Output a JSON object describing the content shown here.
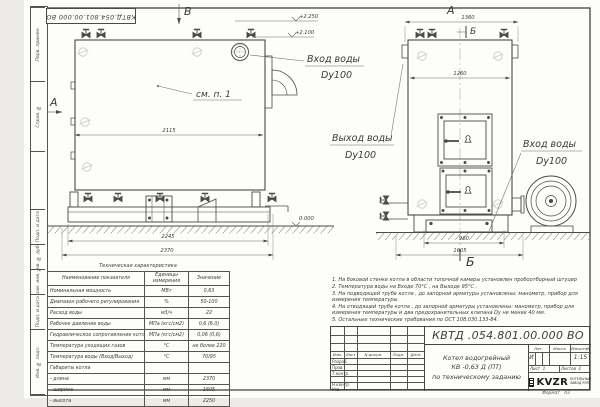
{
  "doc_number_stamp": "КВТД.054.801.00.000 ВО",
  "frame": {
    "side_labels": [
      "Перв. примен.",
      "Справ. №",
      "Подп. и дата",
      "Инв. № дубл.",
      "Взам. инв. №",
      "Подп. и дата",
      "Инв. № подл."
    ]
  },
  "drawing": {
    "b_marker": "В",
    "a_marker_side": "А",
    "see_note": "см. п. 1",
    "elev1": "+2.250",
    "elev2": "+2.100",
    "elev0": "0.000",
    "d2115": "2115",
    "d2245": "2245",
    "d2370": "2370",
    "inlet_top_1": "Вход воды",
    "inlet_top_2": "Dy100",
    "a_title": "А",
    "b_top": "Б",
    "b_bottom": "Б",
    "d1360": "1360",
    "d1260": "1260",
    "d960": "960",
    "d1605": "1605",
    "outlet_1": "Выход воды",
    "outlet_2": "Dy100",
    "inlet_r_1": "Вход воды",
    "inlet_r_2": "Dy100"
  },
  "table": {
    "title": "Техническая характеристика",
    "headers": [
      "Наименование показателя",
      "Единицы измерения",
      "Значение"
    ],
    "rows": [
      [
        "Номинальная мощность",
        "МВт",
        "0,63"
      ],
      [
        "Диапазон рабочего регулирования",
        "%",
        "50-100"
      ],
      [
        "Расход воды",
        "м3/ч",
        "22"
      ],
      [
        "Рабочее давление воды",
        "МПа (кгс/см2)",
        "0,6 (6,0)"
      ],
      [
        "Гидравлическое сопротивление котла",
        "МПа (кгс/см2)",
        "0,06 (0,6)"
      ],
      [
        "Температура уходящих газов",
        "°С",
        "не более 220"
      ],
      [
        "Температура воды (Вход/Выход)",
        "°С",
        "70/95"
      ],
      [
        "Габариты котла",
        "",
        ""
      ],
      [
        "   - длина",
        "мм",
        "2370"
      ],
      [
        "   - ширина",
        "мм",
        "1605"
      ],
      [
        "   - высота",
        "мм",
        "2250"
      ]
    ]
  },
  "notes": {
    "lines": [
      "1.  На боковой стенке котла в области топочной камеры установлен пробоотборный штуцер",
      "2.  Температура воды на Входе  70°С ,  на Выходе  95°С .",
      "3.  На подводящей трубе котла ,  до запорной арматуры установлены:  манометр,  прибор для измерения температуры.",
      "4.  На отводящей трубе котла , до запорной арматуры установлены:  манометр,  прибор для измерения температуры и два предохранительных клапана  Dу не менее  40 мм.",
      "5.  Остальные технические требования по ОСТ  108.030.133-84."
    ]
  },
  "titleblock": {
    "number": "КВТД .054.801.00.000  ВО",
    "product_line1": "Котел водогрейный",
    "product_line2": "КВ -0,63  Д  (ПТ)",
    "product_line3": "по техническому заданию",
    "cols": [
      "Изм.",
      "Лист",
      "N докум.",
      "Подп.",
      "Дата"
    ],
    "roles": [
      "Разраб.",
      "Пров.",
      "Т.контр.",
      "",
      "Н.контр.",
      "Утв."
    ],
    "lit_label": "Лит.",
    "lit_value": "И",
    "mass_label": "Масса",
    "scale_label": "Масштаб",
    "scale_value": "1:15",
    "sheet_label": "Лист",
    "sheet_num": "1",
    "sheets_label": "Листов",
    "sheets_num": "2",
    "logo_text": "KVZR",
    "logo_cap1": "КОТЕЛЬНЫЙ",
    "logo_cap2": "ЗАВОД РЭП",
    "format_label": "Формат",
    "format_value": "А3"
  }
}
